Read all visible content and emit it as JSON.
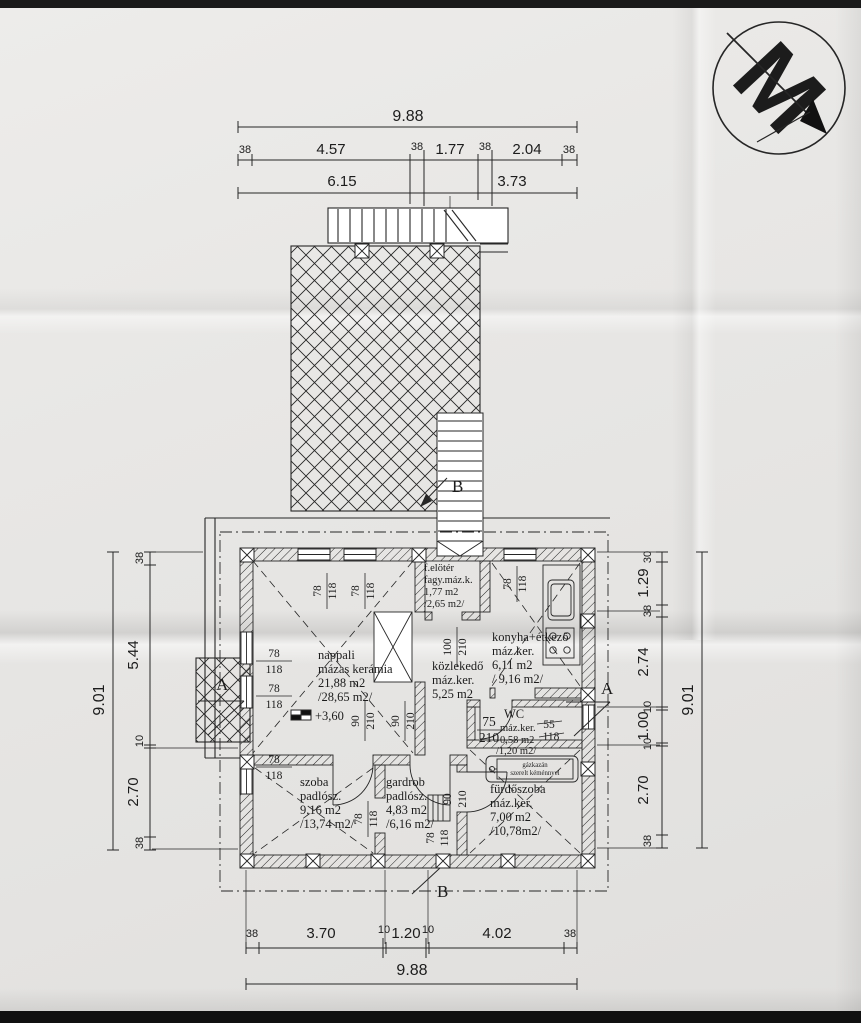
{
  "logo": {
    "letter": "M"
  },
  "dims": {
    "top": {
      "overall": "9.88",
      "row": [
        "38",
        "4.57",
        "38",
        "1.77",
        "38",
        "2.04",
        "38"
      ],
      "sub": [
        "6.15",
        "3.73"
      ]
    },
    "left": {
      "overall": "9.01",
      "row": [
        "38",
        "5.44",
        "10",
        "2.70",
        "38"
      ]
    },
    "right": {
      "overall": "9.01",
      "row": [
        "30",
        "1.29",
        "38",
        "2.74",
        "10",
        "1.00",
        "10",
        "2.70",
        "38"
      ]
    },
    "bottom": {
      "overall": "9.88",
      "row": [
        "38",
        "3.70",
        "10",
        "1.20",
        "10",
        "4.02",
        "38"
      ]
    }
  },
  "rooms": {
    "nappali": {
      "name": "nappali",
      "finish": "mázas kerámia",
      "net": "21,88 m2",
      "gross": "/28,65 m2/"
    },
    "eloter": {
      "name": "f.elötér",
      "finish": "fagy.máz.k.",
      "net": "1,77 m2",
      "gross": "/2,65 m2/"
    },
    "konyha": {
      "name": "konyha+étkező",
      "finish": "máz.ker.",
      "net": "6,11 m2",
      "gross": "/ 9,16 m2/"
    },
    "kozlekedo": {
      "name": "közlekedő",
      "finish": "máz.ker.",
      "net": "5,25 m2"
    },
    "wc": {
      "name": "WC",
      "finish": "máz.ker.",
      "net": "0,58 m2",
      "gross": "/1,20 m2/"
    },
    "furdoszoba": {
      "name": "fürdőszoba",
      "finish": "máz.ker.",
      "net": "7,00 m2",
      "gross": "/10,78m2/"
    },
    "szoba": {
      "name": "szoba",
      "finish": "padlósz.",
      "net": "9,16 m2",
      "gross": "/13,74 m2/"
    },
    "gardrob": {
      "name": "gardrob",
      "finish": "padlósz.",
      "net": "4,83 m2",
      "gross": "/6,16 m2/"
    }
  },
  "openings": {
    "win78": {
      "w": "78",
      "h": "118"
    },
    "door90": {
      "w": "90",
      "h": "210"
    },
    "door100": {
      "w": "100",
      "h": "210"
    },
    "door75": {
      "w": "75",
      "h": "210"
    },
    "win55": {
      "w": "55",
      "h": "118"
    }
  },
  "annotations": {
    "elevation": "+3,60",
    "boiler_line1": "gázkazán",
    "boiler_line2": "szerelt kéménnyel",
    "section_a": "A",
    "section_b": "B"
  }
}
